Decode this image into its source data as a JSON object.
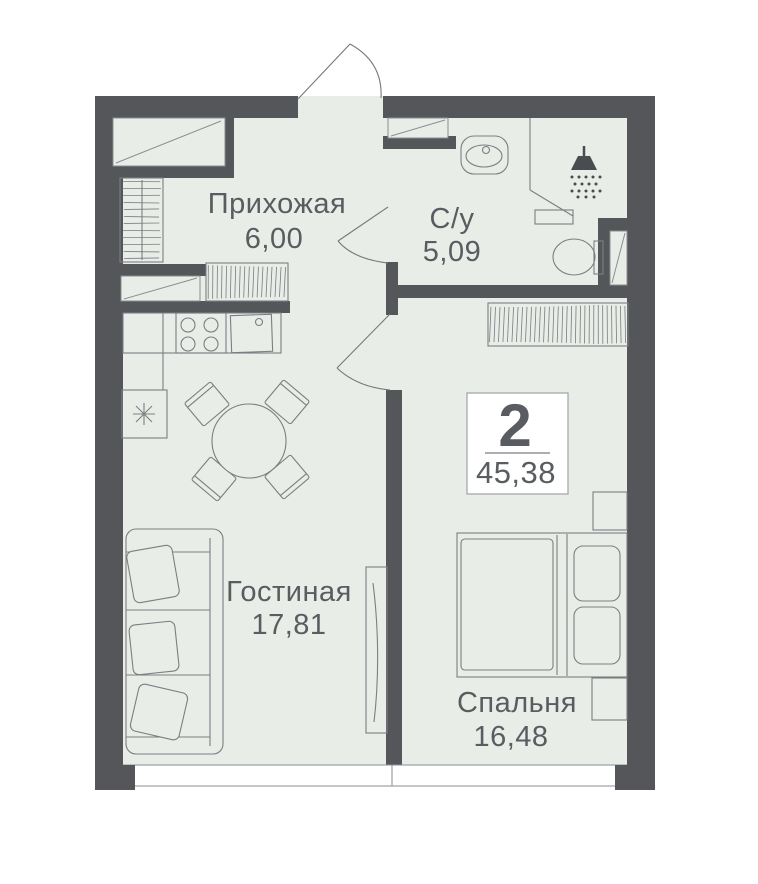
{
  "plan": {
    "type": "apartment-floor-plan",
    "unit_box": {
      "rooms_count": "2",
      "total_area": "45,38"
    },
    "rooms": [
      {
        "label": "Прихожая",
        "area": "6,00"
      },
      {
        "label": "С/у",
        "area": "5,09"
      },
      {
        "label": "Гостиная",
        "area": "17,81"
      },
      {
        "label": "Спальня",
        "area": "16,48"
      }
    ],
    "fixtures": [
      "entrance-door-icon",
      "closet-icon",
      "wardrobe-hatch-icon",
      "kitchen-stove-icon",
      "kitchen-sink-icon",
      "fridge-snowflake-icon",
      "dining-table-icon",
      "chair-icon",
      "sofa-icon",
      "tv-console-icon",
      "bathroom-sink-icon",
      "shower-icon",
      "toilet-icon",
      "shaft-icon",
      "bed-icon",
      "nightstand-icon",
      "window-band-icon",
      "door-swing-icon"
    ],
    "colors": {
      "wall": "#54565A",
      "floor": "#E9EDE7",
      "outline": "#7B7E82",
      "text": "#595C60",
      "background": "#FFFFFF"
    }
  }
}
